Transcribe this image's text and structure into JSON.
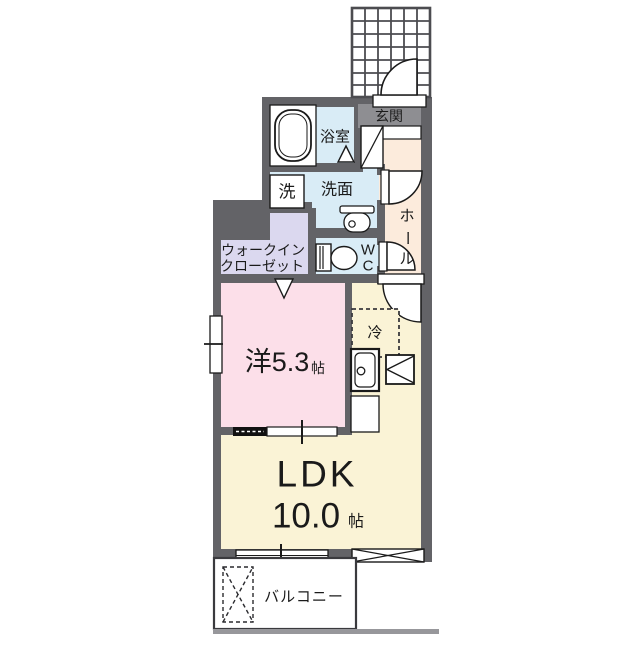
{
  "plan": {
    "entrance": {
      "label": "玄関"
    },
    "bathroom": {
      "label": "浴室"
    },
    "laundry": {
      "label": "洗"
    },
    "washroom": {
      "label": "洗面"
    },
    "hall": {
      "label": "ホール",
      "chars": [
        "ホ",
        "ー",
        "ル"
      ]
    },
    "toilet": {
      "label": "WC",
      "chars": [
        "W",
        "C"
      ]
    },
    "closet": {
      "label": "ウォークインクローゼット",
      "line1": "ウォークイン",
      "line2": "クローゼット"
    },
    "western_room": {
      "label": "洋5.3帖",
      "main": "洋5.3",
      "unit": "帖"
    },
    "refrigerator": {
      "label": "冷"
    },
    "ldk": {
      "label": "LDK",
      "size_main": "10.0",
      "size_unit": "帖"
    },
    "balcony": {
      "label": "バルコニー"
    }
  },
  "colors": {
    "wall": "#636367",
    "wet_area_blue": "#d9ecf6",
    "hall_cream": "#fcebdc",
    "closet_lavender": "#dbd8ef",
    "room_pink": "#fcdfe9",
    "ldk_cream": "#faf3d6",
    "entrance_label_gray": "#8e8e92",
    "line": "#1a1a1a"
  }
}
